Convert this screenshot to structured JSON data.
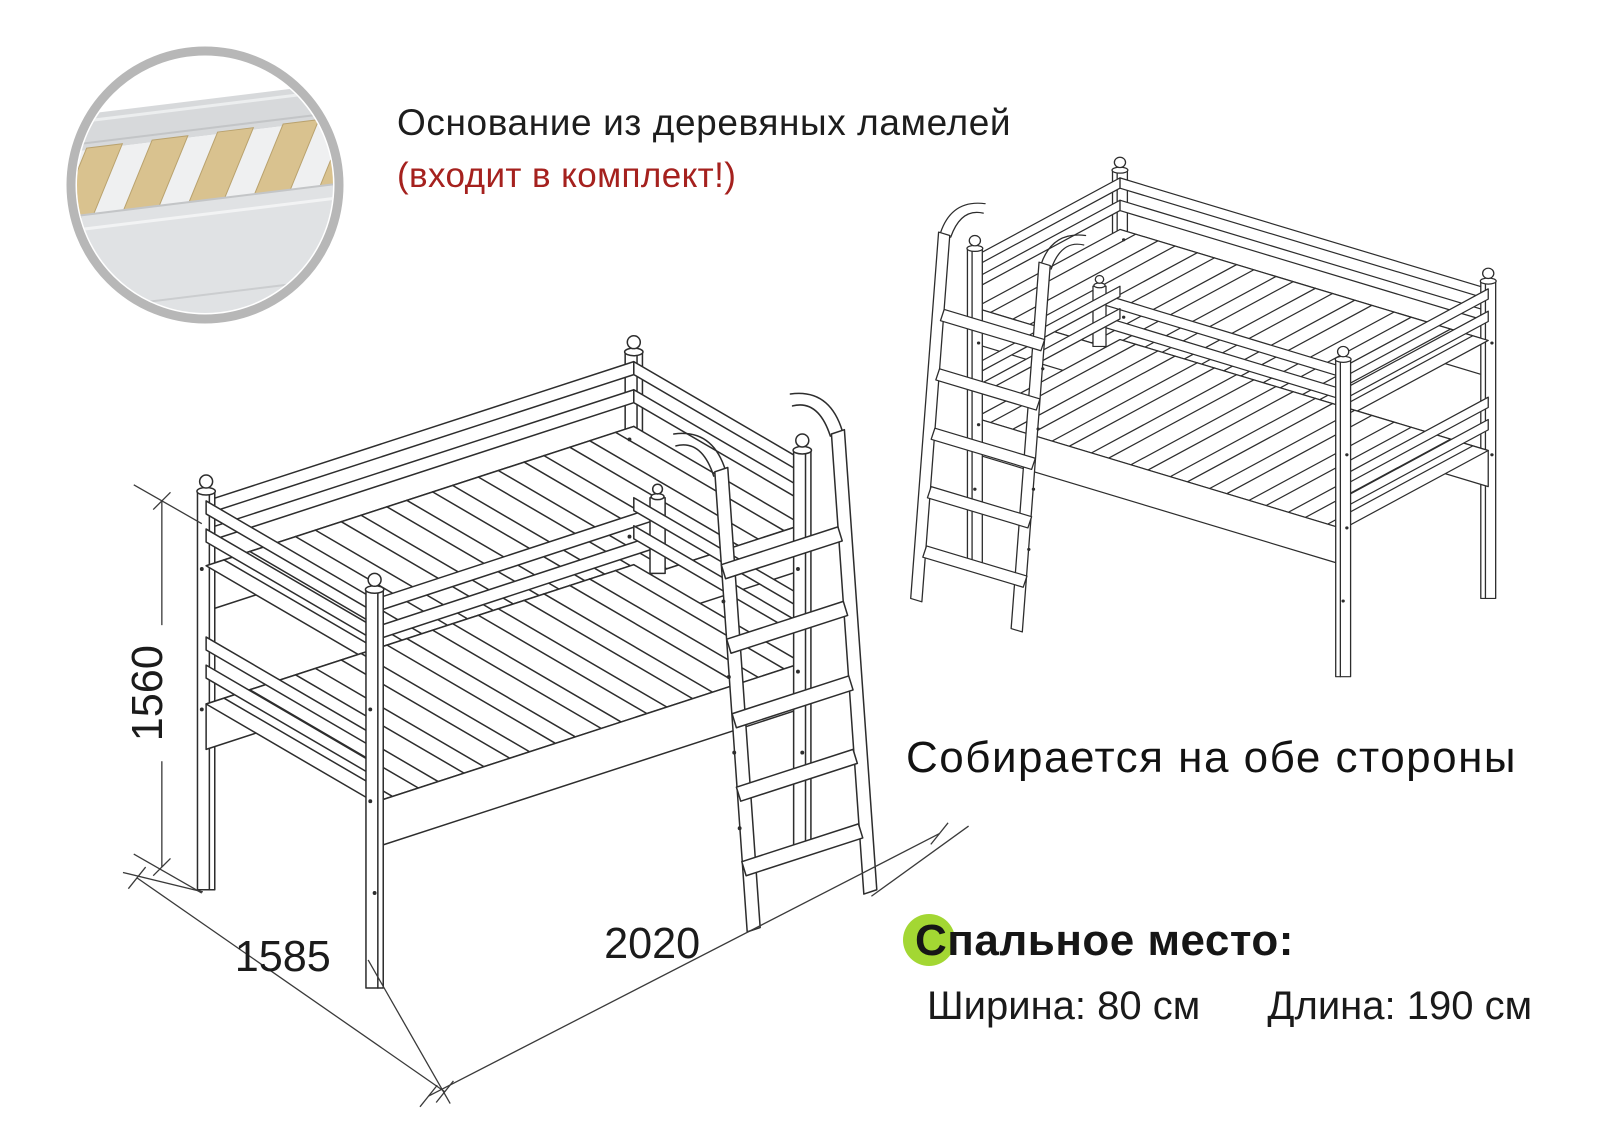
{
  "header": {
    "title": "Основание из деревяных ламелей",
    "subtitle": "(входит в комплект!)"
  },
  "left_drawing": {
    "dimensions": {
      "height_mm": "1560",
      "width_mm": "1585",
      "length_mm": "2020"
    }
  },
  "right_drawing": {
    "caption": "Собирается на обе стороны"
  },
  "sleeping_area": {
    "heading": "Спальное место:",
    "width_label": "Ширина: 80 см",
    "length_label": "Длина: 190 см"
  },
  "colors": {
    "accent_red": "#a5211e",
    "bullet_green": "#a3d733",
    "drawing_line": "#2d2d2d",
    "inset_ring_gray": "#b7b7b7",
    "wood_slat": "#d9c28f"
  }
}
